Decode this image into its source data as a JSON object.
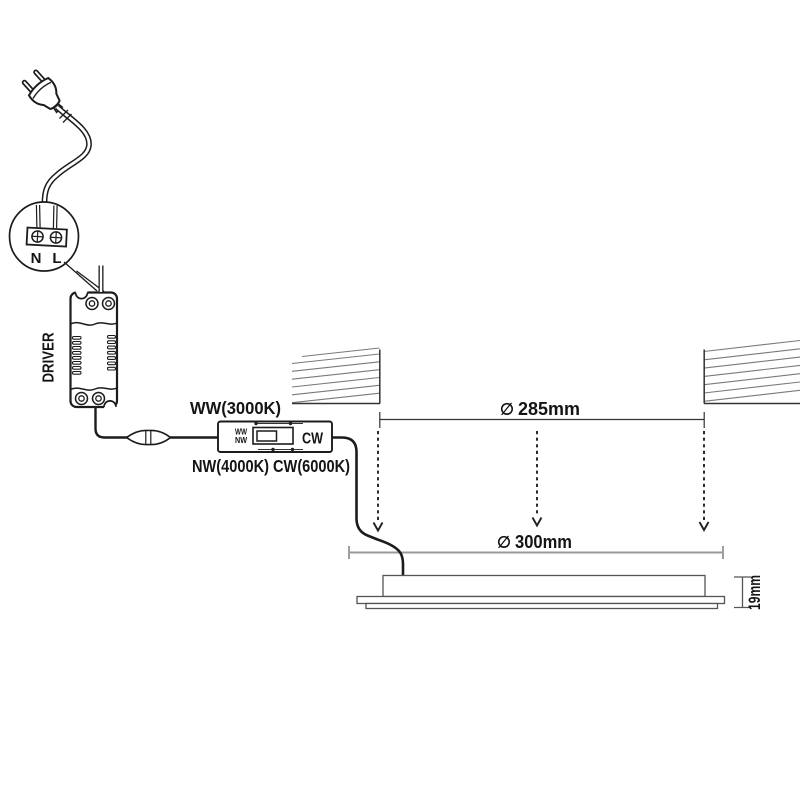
{
  "terminal_block": {
    "neutral_label": "N",
    "live_label": "L"
  },
  "driver": {
    "label": "DRIVER"
  },
  "cct_switch": {
    "ww_small": "WW",
    "nw_small": "NW",
    "cw_label": "CW",
    "top_label": "WW(3000K)",
    "bottom_label": "NW(4000K) CW(6000K)"
  },
  "dimensions": {
    "cutout_symbol": "∅",
    "cutout_value": "285mm",
    "panel_symbol": "∅",
    "panel_value": "300mm",
    "height_value": "19mm"
  },
  "colors": {
    "ink": "#1c1c1c",
    "dimension_line_grey": "#999999",
    "panel_outline": "#555555",
    "hatch": "#7a7a7a",
    "background": "#ffffff"
  }
}
